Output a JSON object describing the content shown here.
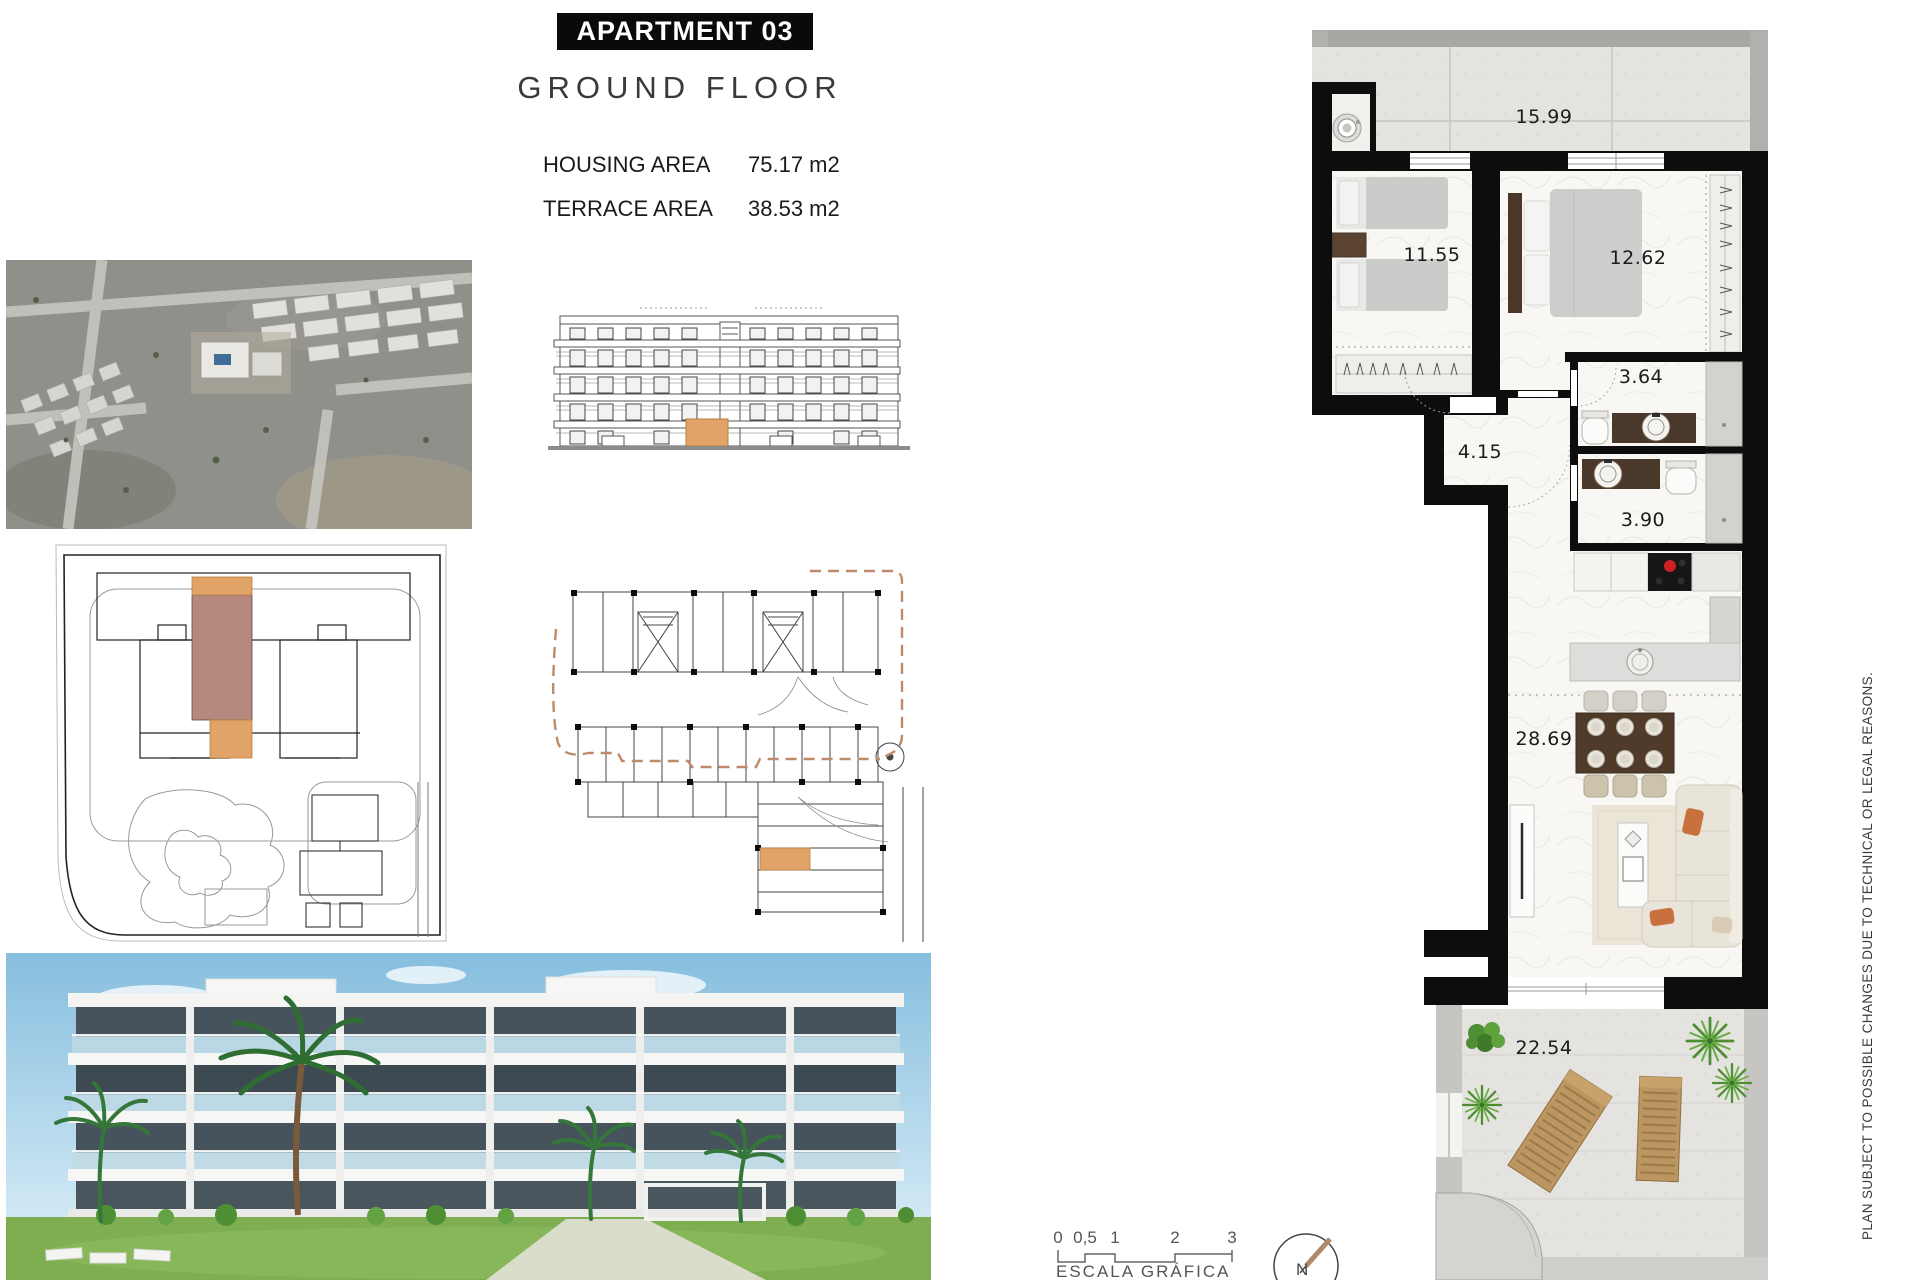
{
  "page": {
    "title": "APARTMENT 03",
    "subtitle": "GROUND FLOOR"
  },
  "areas": {
    "housing": {
      "label": "HOUSING AREA",
      "value": "75.17 m2"
    },
    "terrace": {
      "label": "TERRACE AREA",
      "value": "38.53 m2"
    }
  },
  "floor_plan": {
    "rooms": {
      "terrace_top": "15.99",
      "bedroom_1": "11.55",
      "bedroom_2": "12.62",
      "bathroom_1": "3.64",
      "hallway": "4.15",
      "bathroom_2": "3.90",
      "living_kitchen": "28.69",
      "terrace_bottom": "22.54"
    }
  },
  "scale_bar": {
    "ticks": [
      "0",
      "0,5",
      "1",
      "2",
      "3"
    ],
    "caption": "ESCALA GRÁFICA"
  },
  "compass": {
    "north_label": "N"
  },
  "disclaimer": "PLAN SUBJECT TO POSSIBLE CHANGES DUE TO TECHNICAL OR LEGAL REASONS.",
  "icons": {
    "washer": "washing-machine-icon",
    "compass": "north-compass-icon",
    "stove": "cooktop-icon",
    "sink": "sink-icon"
  },
  "colors": {
    "highlight_orange": "#E2A368",
    "highlight_salmon": "#B5897D",
    "boundary_dash": "#C08A6A",
    "wall_black": "#0D0D0D",
    "burner_red": "#CC2222",
    "wood_brown": "#503B2B",
    "plant_green": "#4E8F33",
    "pool_blue": "#3F6F99"
  }
}
